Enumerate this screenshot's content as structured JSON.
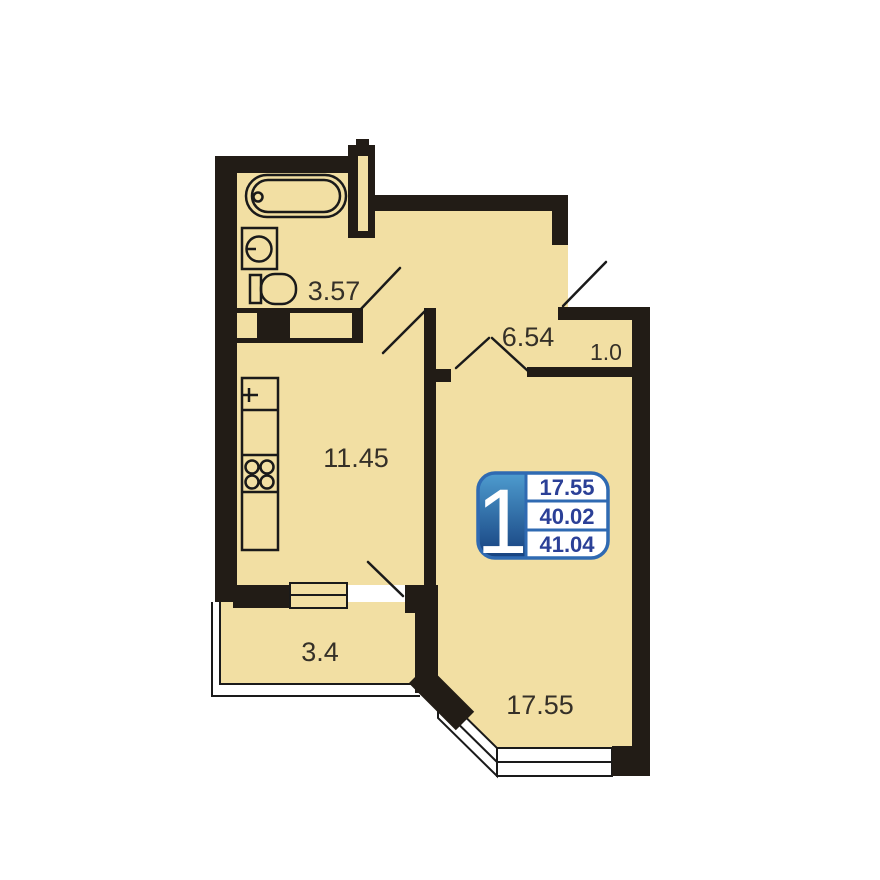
{
  "colors": {
    "background": "#ffffff",
    "floor": "#f2dfa3",
    "wall": "#221c16",
    "line": "#1a1a1a",
    "label": "#353028",
    "badge_blue": "#2f6ab2",
    "badge_text": "#2b4097",
    "badge_grad_top": "#4e9ccf",
    "badge_grad_bottom": "#16417f"
  },
  "badge": {
    "room_count": "1",
    "living_area": "17.55",
    "apartment_area": "40.02",
    "total_area": "41.04"
  },
  "rooms": {
    "bathroom": {
      "label": "3.57"
    },
    "hallway": {
      "label": "6.54"
    },
    "closet": {
      "label": "1.0"
    },
    "kitchen": {
      "label": "11.45"
    },
    "balcony": {
      "label": "3.4"
    },
    "living_room": {
      "label": "17.55"
    }
  },
  "fixtures": [
    "bathtub",
    "washing-machine",
    "toilet",
    "kitchen-sink",
    "stove-4-burner",
    "kitchen-counter",
    "ventilation-shaft",
    "balcony-window-door-unit",
    "bay-window",
    "entrance-door-swing",
    "interior-door-swings"
  ]
}
